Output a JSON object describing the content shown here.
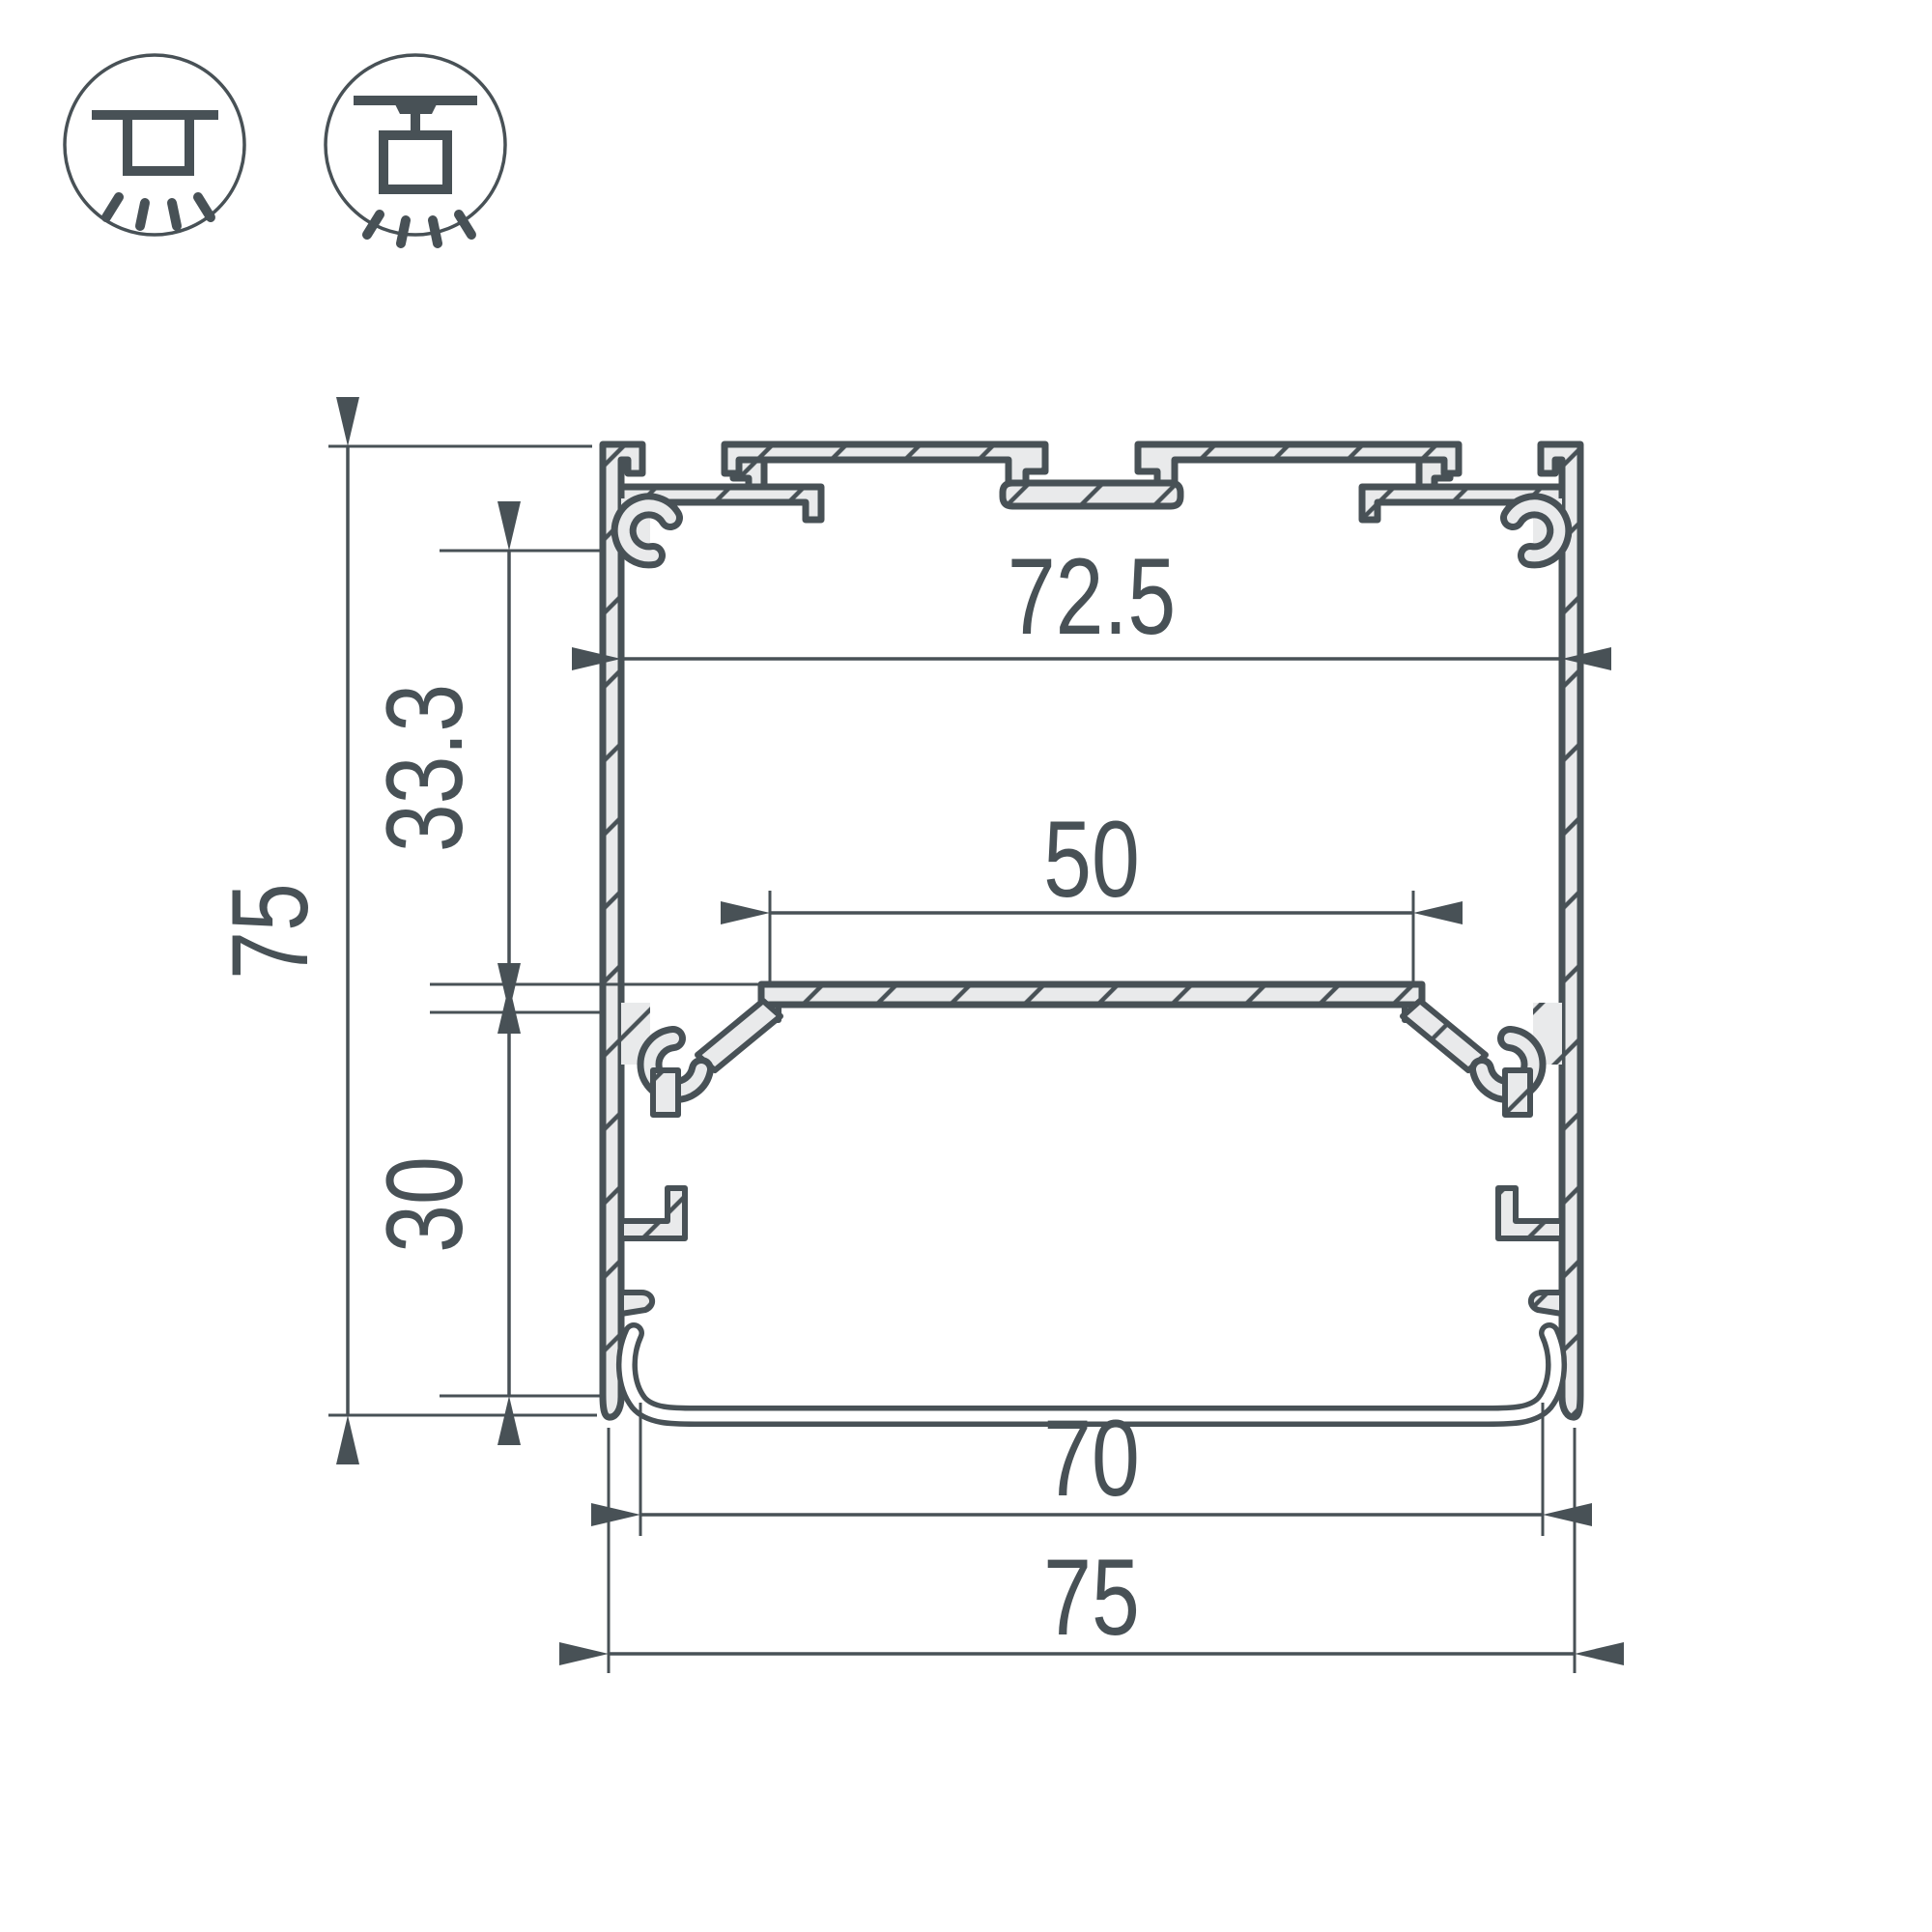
{
  "colors": {
    "ink": "#485156",
    "metal_fill": "#e9eaeb",
    "background": "#ffffff"
  },
  "icons": [
    {
      "name": "surface-mount-icon",
      "meaning": "surface ceiling mounted luminaire"
    },
    {
      "name": "suspended-mount-icon",
      "meaning": "suspended pendant mounted luminaire"
    }
  ],
  "drawing": {
    "type": "profile-cross-section",
    "dim_inner_width": "72.5",
    "dim_led_plate_width": "50",
    "dim_top_to_plate": "33.3",
    "dim_plate_to_bottom": "30",
    "dim_overall_height": "75",
    "dim_diffuser_width": "70",
    "dim_overall_width": "75"
  }
}
